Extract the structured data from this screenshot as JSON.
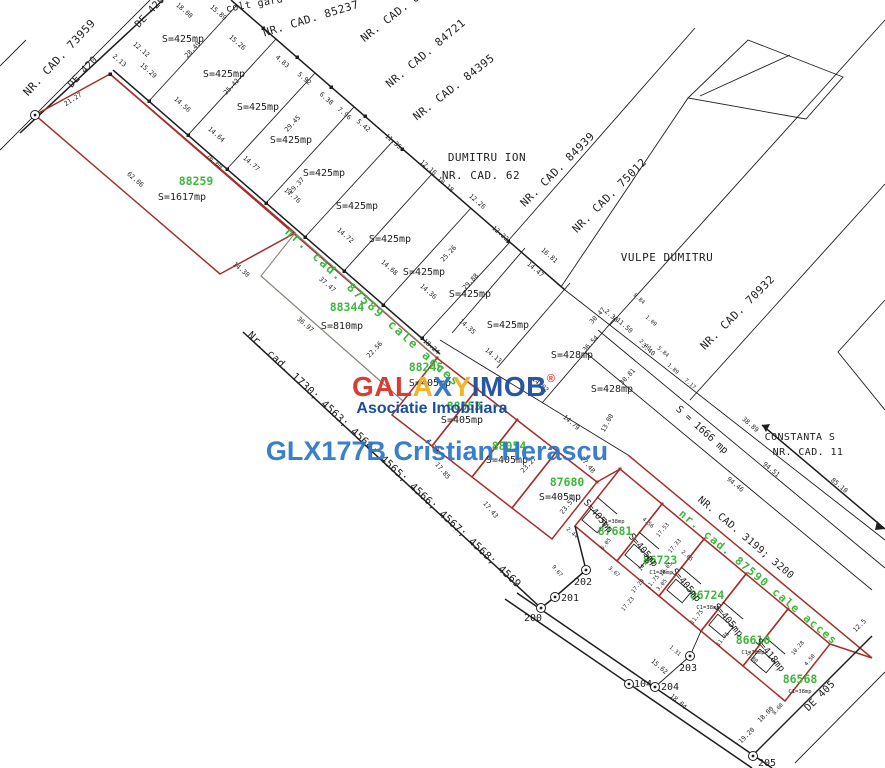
{
  "watermark": {
    "letters": [
      {
        "ch": "G",
        "color": "#d8342c"
      },
      {
        "ch": "A",
        "color": "#d8342c"
      },
      {
        "ch": "L",
        "color": "#d8342c"
      },
      {
        "ch": "A",
        "color": "#f2b01e"
      },
      {
        "ch": "X",
        "color": "#2e74c8"
      },
      {
        "ch": "Y",
        "color": "#f2b01e"
      },
      {
        "ch": "I",
        "color": "#1d4e9e"
      },
      {
        "ch": "M",
        "color": "#1d4e9e"
      },
      {
        "ch": "O",
        "color": "#1d4e9e"
      },
      {
        "ch": "B",
        "color": "#1d4e9e"
      }
    ],
    "registered": "®",
    "subtitle": "Asociatie Imobiliara",
    "agent": "GLX177B Cristian Herascu"
  },
  "roads": {
    "de420": "DE 420",
    "de405": "DE 405",
    "cale_acces_1": "nr. cad. 87589 cale acces",
    "cale_acces_2": "nr. cad. 87590 cale acces"
  },
  "neighbors": {
    "colt_gard": "colt gard",
    "cad73959": "NR. CAD. 73959",
    "cad85237": "NR. CAD. 85237",
    "cad847": "NR. CAD. 847",
    "cad84721": "NR. CAD. 84721",
    "cad84395": "NR. CAD. 84395",
    "dumitru_ion": "DUMITRU ION",
    "cad62": "NR. CAD. 62",
    "cad84939": "NR. CAD. 84939",
    "cad75012": "NR. CAD. 75012",
    "vulpe": "VULPE DUMITRU",
    "cad70932": "NR. CAD. 70932",
    "constanta": "CONSTANTA S",
    "cad11": "NR. CAD. 11",
    "cad3199": "NR. CAD. 3199; 3200",
    "cad1730": "Nr. cad. 1730; 4563; 4564; 4565; 4566; 4567; 4568; 4569"
  },
  "strip": {
    "area425": "S=425mp",
    "area428": "S=428mp",
    "area1666": "S = 1666 mp"
  },
  "parcels": [
    {
      "id": "88259",
      "area": "S=1617mp"
    },
    {
      "id": "88344",
      "area": "S=810mp"
    },
    {
      "id": "88245",
      "area": "S=405mp"
    },
    {
      "id": "88053",
      "area": "S=405mp"
    },
    {
      "id": "88054",
      "area": "S=405mp"
    },
    {
      "id": "87680",
      "area": "S=405mp"
    },
    {
      "id": "87681",
      "area": "S=405mp",
      "building": "C1=38mp"
    },
    {
      "id": "86723",
      "area": "S=405mp",
      "building": "C1=38mp"
    },
    {
      "id": "86724",
      "area": "S=405mp",
      "building": "C1=38mp"
    },
    {
      "id": "86610",
      "area": "S=405mp",
      "building": "C1=38mp"
    },
    {
      "id": "86568",
      "area": "S=418mp",
      "building": "C1=38mp"
    }
  ],
  "points": {
    "p200": "200",
    "p201": "201",
    "p202": "202",
    "p203": "203",
    "p204": "204",
    "p205": "205",
    "p104": "104"
  },
  "measurements": [
    {
      "v": "21.27"
    },
    {
      "v": "2.13"
    },
    {
      "v": "12.12"
    },
    {
      "v": "15.29"
    },
    {
      "v": "18.00"
    },
    {
      "v": "15.89"
    },
    {
      "v": "14.56"
    },
    {
      "v": "14.64"
    },
    {
      "v": "14.77"
    },
    {
      "v": "14.76"
    },
    {
      "v": "14.72"
    },
    {
      "v": "14.68"
    },
    {
      "v": "14.36"
    },
    {
      "v": "14.35"
    },
    {
      "v": "14.13"
    },
    {
      "v": "14.02"
    },
    {
      "v": "28.49"
    },
    {
      "v": "25.42"
    },
    {
      "v": "29.45"
    },
    {
      "v": "29.37"
    },
    {
      "v": "29.88"
    },
    {
      "v": "30.47"
    },
    {
      "v": "36.54"
    },
    {
      "v": "30.81"
    },
    {
      "v": "25.26"
    },
    {
      "v": "15.26"
    },
    {
      "v": "4.83"
    },
    {
      "v": "5.92"
    },
    {
      "v": "6.38"
    },
    {
      "v": "7.96"
    },
    {
      "v": "5.42"
    },
    {
      "v": "11.35"
    },
    {
      "v": "12.16"
    },
    {
      "v": "10.18"
    },
    {
      "v": "12.26"
    },
    {
      "v": "12.22"
    },
    {
      "v": "16.81"
    },
    {
      "v": "14.47"
    },
    {
      "v": "11.50"
    },
    {
      "v": "2.38"
    },
    {
      "v": "3.40"
    },
    {
      "v": "13.00"
    },
    {
      "v": "85.10"
    },
    {
      "v": "94.51"
    },
    {
      "v": "94.46"
    },
    {
      "v": "38.89"
    },
    {
      "v": "76.60"
    },
    {
      "v": "62.06"
    },
    {
      "v": "14.30"
    },
    {
      "v": "22.56"
    },
    {
      "v": "37.47"
    },
    {
      "v": "36.97"
    },
    {
      "v": "18.24"
    },
    {
      "v": "23.51"
    },
    {
      "v": "23.27"
    },
    {
      "v": "17.85"
    },
    {
      "v": "17.43"
    },
    {
      "v": "17.48"
    },
    {
      "v": "4.79"
    },
    {
      "v": "9.67"
    },
    {
      "v": "2.44"
    },
    {
      "v": "3.67"
    },
    {
      "v": "17.29"
    },
    {
      "v": "17.33"
    },
    {
      "v": "17.53"
    },
    {
      "v": "11.75"
    },
    {
      "v": "10.05"
    },
    {
      "v": "14.00"
    },
    {
      "v": "11.75"
    },
    {
      "v": "10.28"
    },
    {
      "v": "15.62"
    },
    {
      "v": "18.04"
    },
    {
      "v": "8.60"
    },
    {
      "v": "18.00"
    },
    {
      "v": "19.20"
    },
    {
      "v": "1.31"
    },
    {
      "v": "12.5"
    },
    {
      "v": "7.80"
    },
    {
      "v": "4.50"
    },
    {
      "v": "5.84"
    },
    {
      "v": "1.89"
    },
    {
      "v": "7.17"
    },
    {
      "v": "2.40"
    },
    {
      "v": "14.79"
    },
    {
      "v": "11.75"
    },
    {
      "v": "6.05"
    },
    {
      "v": "8.84"
    },
    {
      "v": "1.09"
    },
    {
      "v": "17.23"
    },
    {
      "v": "4.56"
    },
    {
      "v": "2.65"
    },
    {
      "v": "3.05"
    }
  ]
}
